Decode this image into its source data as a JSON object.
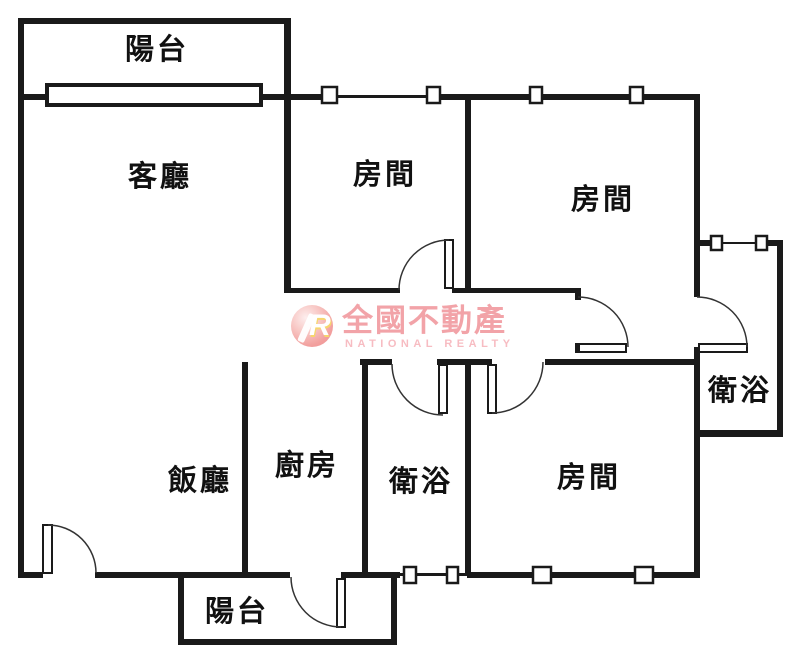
{
  "plan": {
    "rooms": {
      "balcony_top": {
        "label": "陽台"
      },
      "living": {
        "label": "客廳"
      },
      "bedroom_top": {
        "label": "房間"
      },
      "bedroom_right": {
        "label": "房間"
      },
      "bath_right": {
        "label": "衛浴"
      },
      "dining": {
        "label": "飯廳"
      },
      "kitchen": {
        "label": "廚房"
      },
      "bath_middle": {
        "label": "衛浴"
      },
      "bedroom_bottom": {
        "label": "房間"
      },
      "balcony_bottom": {
        "label": "陽台"
      }
    }
  },
  "logo": {
    "symbol": "R",
    "title": "全國不動產",
    "subtitle": "NATIONAL REALTY",
    "title_color": "#f2a3a8",
    "subtitle_color": "#f7bcc2"
  },
  "colors": {
    "wall": "#1a1a1a",
    "background": "#ffffff"
  }
}
